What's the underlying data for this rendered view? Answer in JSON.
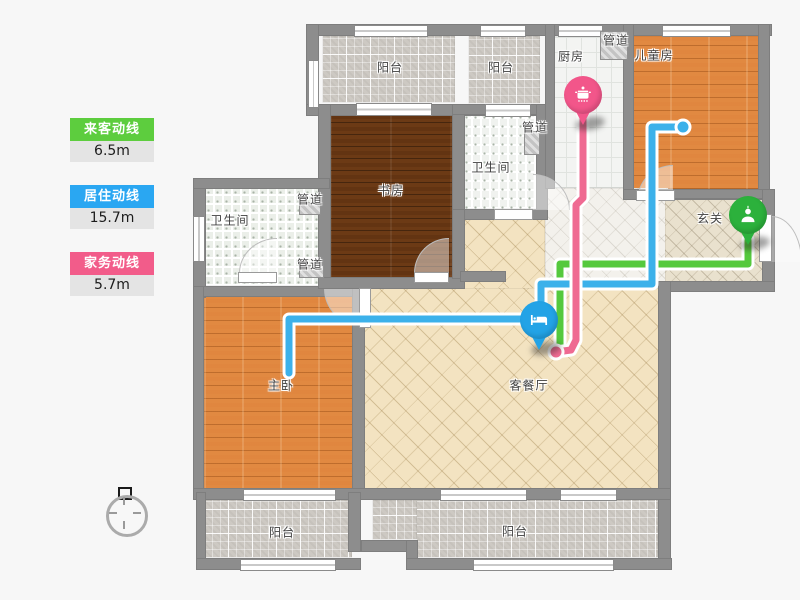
{
  "legend": {
    "items": [
      {
        "name": "visitor-line",
        "label": "来客动线",
        "value": "6.5m",
        "color": "#5dcd3e"
      },
      {
        "name": "living-line",
        "label": "居住动线",
        "value": "15.7m",
        "color": "#2aa7f2"
      },
      {
        "name": "chore-line",
        "label": "家务动线",
        "value": "5.7m",
        "color": "#f25c8a"
      }
    ]
  },
  "rooms": [
    {
      "name": "balcony-top-left",
      "label": "阳台",
      "x": 390,
      "y": 67
    },
    {
      "name": "balcony-top-mid",
      "label": "阳台",
      "x": 501,
      "y": 67
    },
    {
      "name": "kitchen",
      "label": "厨房",
      "x": 571,
      "y": 56
    },
    {
      "name": "duct-kitchen",
      "label": "管道",
      "x": 616,
      "y": 40
    },
    {
      "name": "kids-room",
      "label": "儿童房",
      "x": 654,
      "y": 55
    },
    {
      "name": "duct-hallway",
      "label": "管道",
      "x": 535,
      "y": 127
    },
    {
      "name": "bathroom-mid",
      "label": "卫生间",
      "x": 491,
      "y": 167
    },
    {
      "name": "study",
      "label": "书房",
      "x": 391,
      "y": 190
    },
    {
      "name": "duct-bath-top",
      "label": "管道",
      "x": 310,
      "y": 199
    },
    {
      "name": "bathroom-left",
      "label": "卫生间",
      "x": 230,
      "y": 220
    },
    {
      "name": "duct-bath-bottom",
      "label": "管道",
      "x": 310,
      "y": 264
    },
    {
      "name": "foyer",
      "label": "玄关",
      "x": 710,
      "y": 218
    },
    {
      "name": "master-bedroom",
      "label": "主卧",
      "x": 281,
      "y": 385
    },
    {
      "name": "living-dining",
      "label": "客餐厅",
      "x": 529,
      "y": 385
    },
    {
      "name": "balcony-bottom-left",
      "label": "阳台",
      "x": 282,
      "y": 532
    },
    {
      "name": "balcony-bottom-right",
      "label": "阳台",
      "x": 515,
      "y": 531
    }
  ],
  "pins": [
    {
      "id": "pin-kitchen",
      "name": "chore-start-pin",
      "icon": "pot-icon",
      "color": "#f2568a",
      "x": 583,
      "y": 126
    },
    {
      "id": "pin-living",
      "name": "living-start-pin",
      "icon": "bed-icon",
      "color": "#23a3e6",
      "x": 539,
      "y": 351
    },
    {
      "id": "pin-foyer",
      "name": "visitor-start-pin",
      "icon": "person-icon",
      "color": "#2cb13c",
      "x": 748,
      "y": 246
    }
  ],
  "routes": [
    {
      "name": "visitor-route",
      "color": "#55c93d",
      "end_dot": false,
      "points": [
        [
          748,
          240
        ],
        [
          748,
          264
        ],
        [
          560,
          264
        ],
        [
          560,
          345
        ]
      ]
    },
    {
      "name": "living-route",
      "color": "#3cb1ea",
      "end_dot": true,
      "points": [
        [
          289,
          373
        ],
        [
          289,
          319
        ],
        [
          541,
          319
        ],
        [
          541,
          284
        ],
        [
          652,
          284
        ],
        [
          652,
          127
        ],
        [
          683,
          127
        ]
      ]
    },
    {
      "name": "chore-route",
      "color": "#ef6a92",
      "end_dot": true,
      "points": [
        [
          583,
          112
        ],
        [
          583,
          198
        ],
        [
          576,
          205
        ],
        [
          576,
          340
        ],
        [
          571,
          350
        ],
        [
          556,
          352
        ]
      ]
    }
  ]
}
